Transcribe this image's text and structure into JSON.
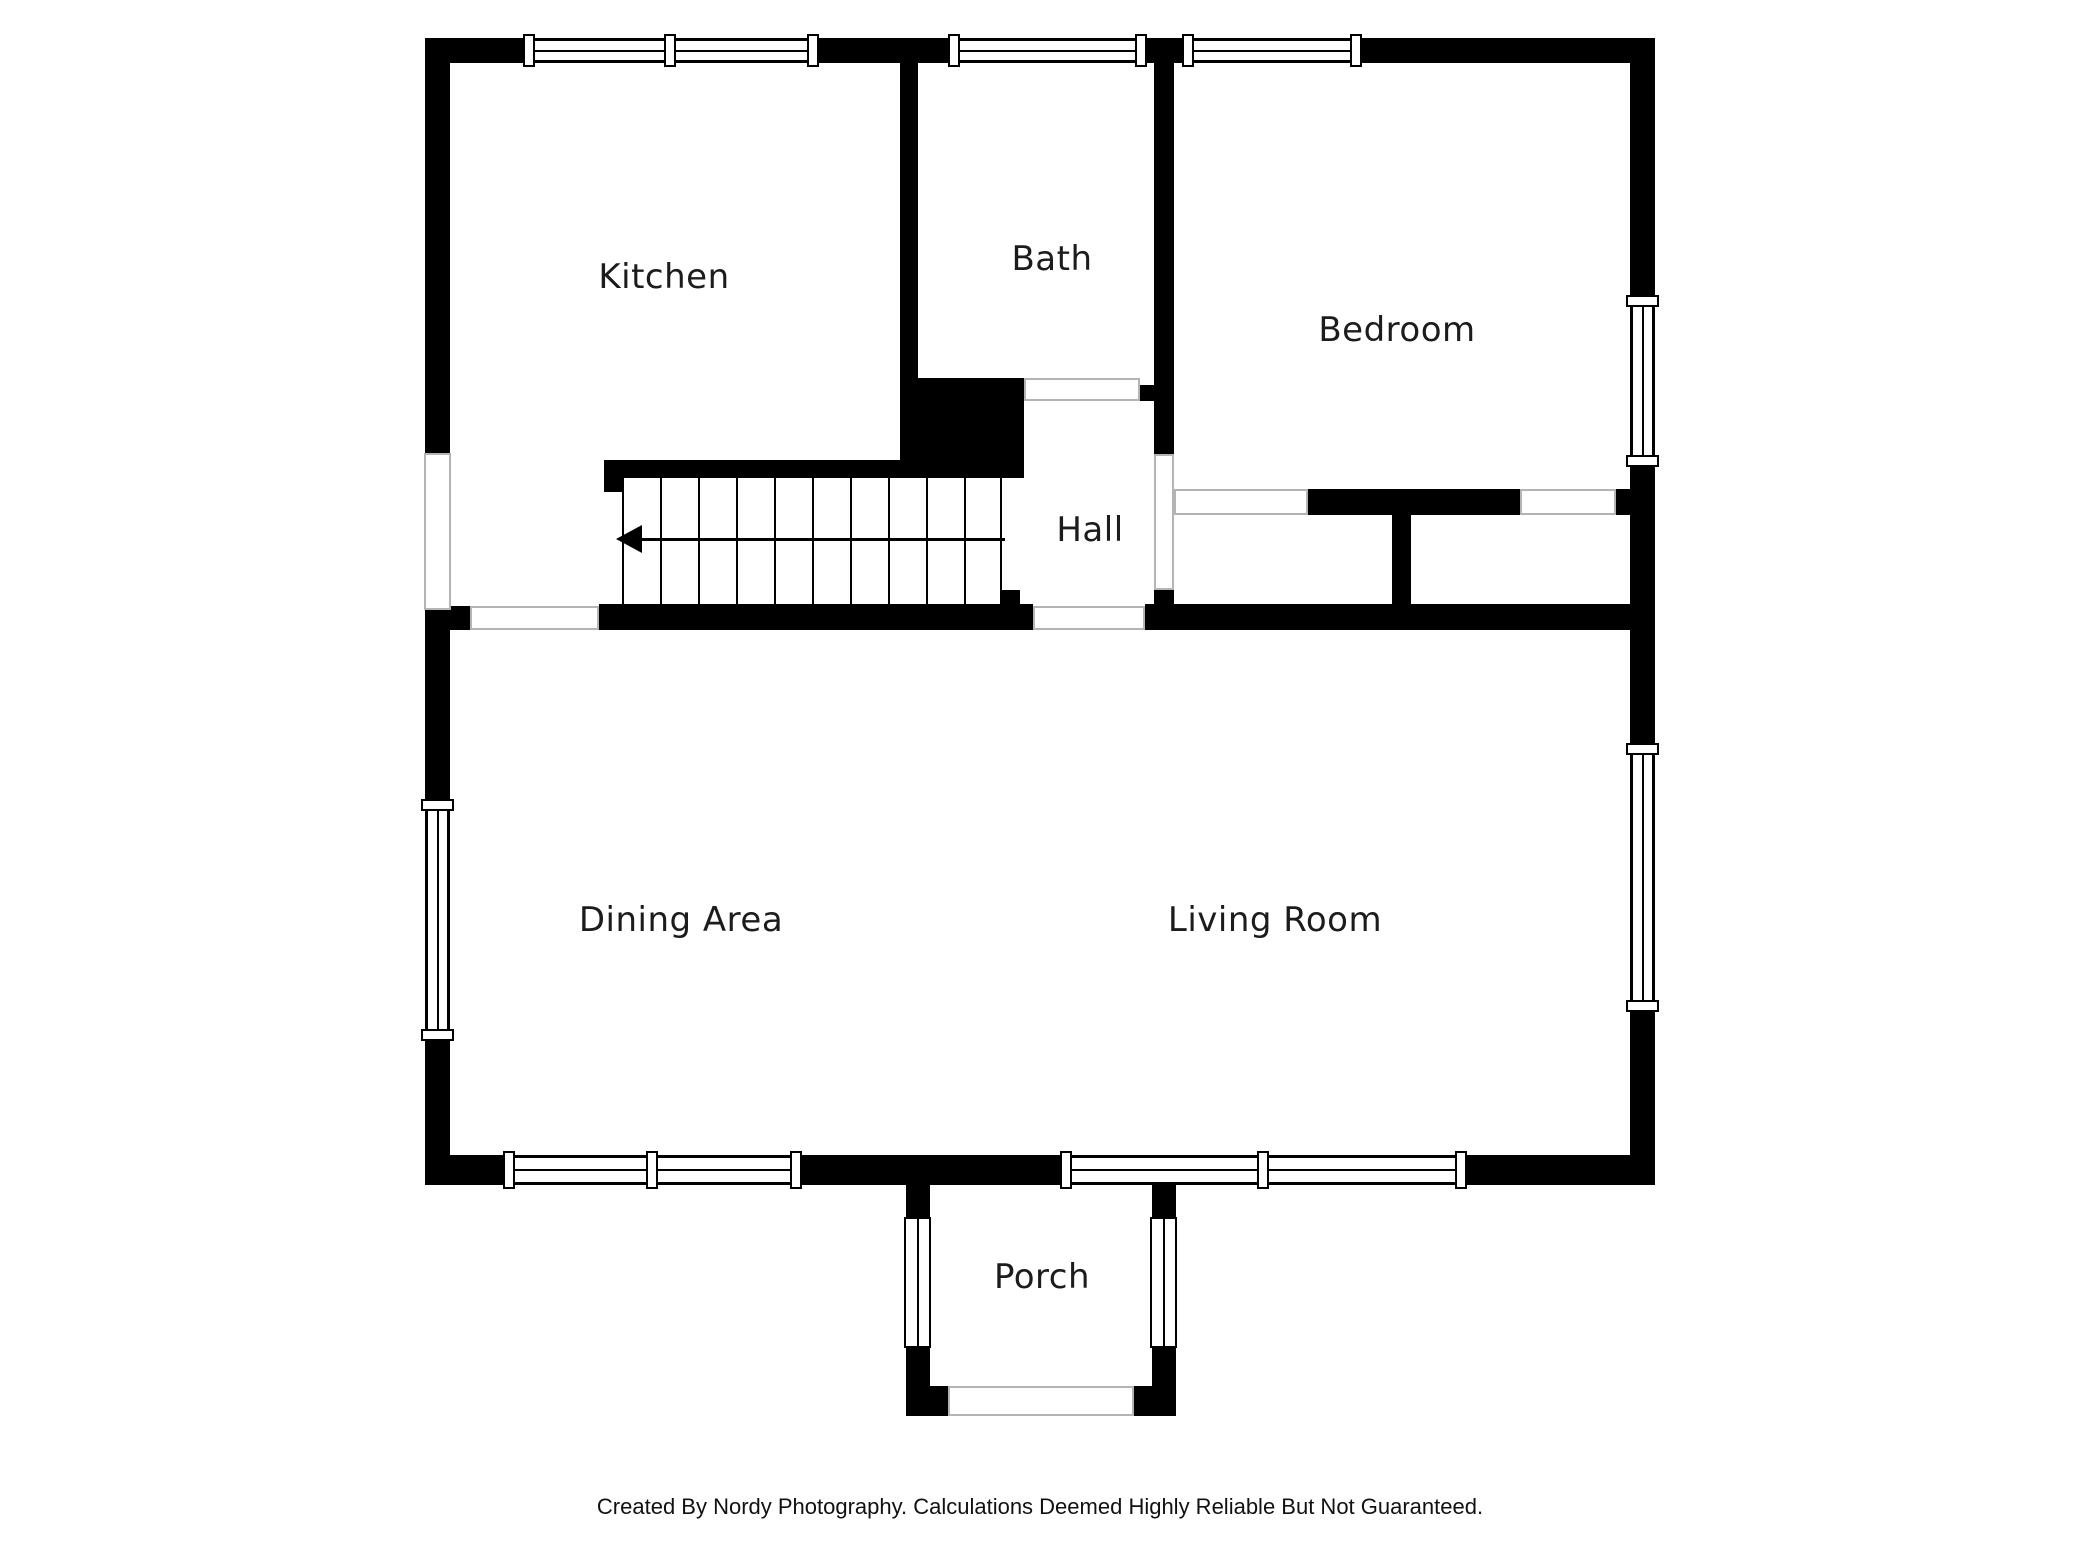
{
  "rooms": [
    {
      "id": "kitchen",
      "label": "Kitchen"
    },
    {
      "id": "bath",
      "label": "Bath"
    },
    {
      "id": "bedroom",
      "label": "Bedroom"
    },
    {
      "id": "hall",
      "label": "Hall"
    },
    {
      "id": "dining-area",
      "label": "Dining Area"
    },
    {
      "id": "living-room",
      "label": "Living Room"
    },
    {
      "id": "porch",
      "label": "Porch"
    }
  ],
  "stairs": {
    "tread_count": 10,
    "direction_arrow": "left"
  },
  "footer": {
    "credit": "Created By Nordy Photography. Calculations Deemed Highly Reliable But Not Guaranteed."
  },
  "colors": {
    "wall": "#000000",
    "background": "#ffffff",
    "opening_outline": "#b4b4b4",
    "label_text": "#1c1c1c"
  }
}
